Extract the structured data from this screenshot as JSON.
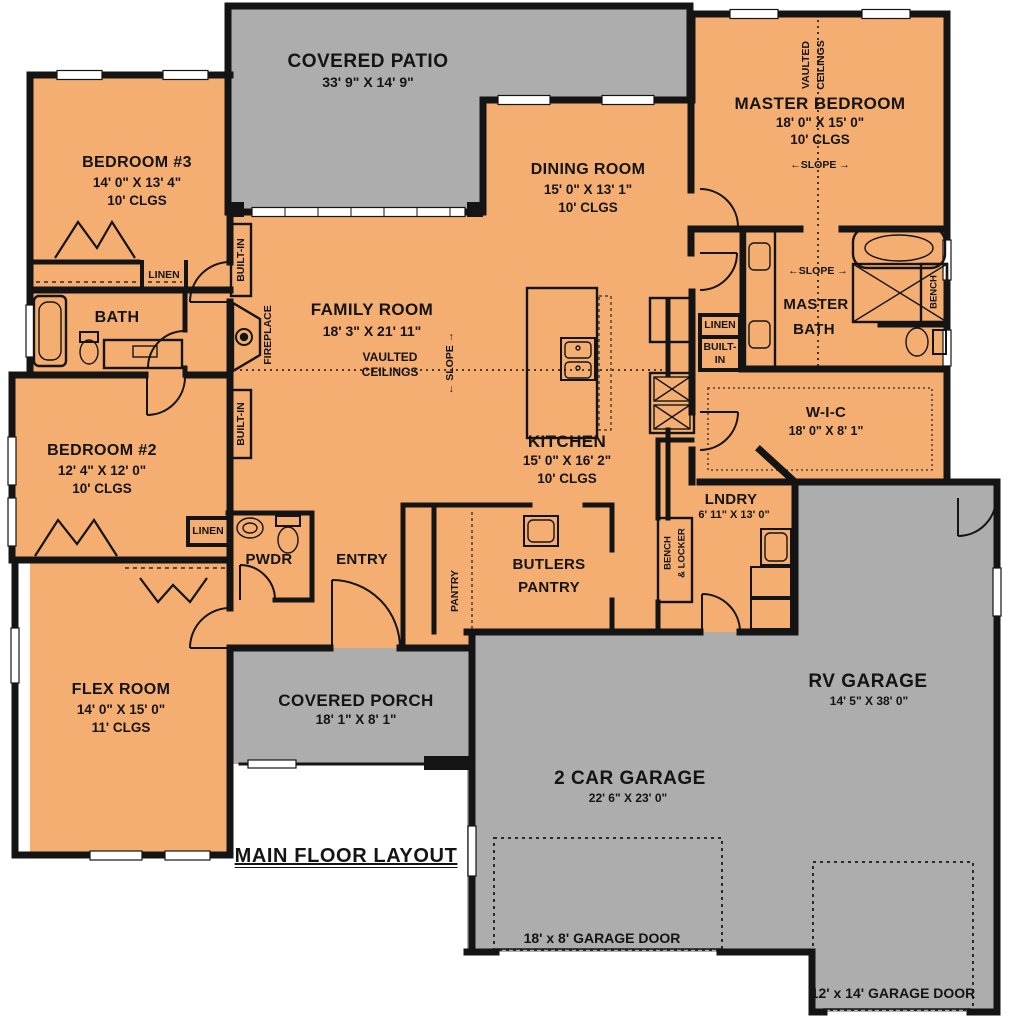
{
  "plan_title": "MAIN FLOOR LAYOUT",
  "colors": {
    "interior": "#F5AE72",
    "outdoor": "#ADADAD",
    "wall": "#141414",
    "background": "#FFFFFF"
  },
  "rooms": {
    "covered_patio": {
      "name": "COVERED PATIO",
      "dims": "33' 9\" X 14' 9\""
    },
    "master_bedroom": {
      "name": "MASTER BEDROOM",
      "dims": "18' 0\" X 15' 0\"",
      "ceiling": "10' CLGS"
    },
    "bedroom_3": {
      "name": "BEDROOM #3",
      "dims": "14' 0\" X 13' 4\"",
      "ceiling": "10' CLGS"
    },
    "dining_room": {
      "name": "DINING ROOM",
      "dims": "15' 0\" X 13' 1\"",
      "ceiling": "10' CLGS"
    },
    "family_room": {
      "name": "FAMILY ROOM",
      "dims": "18' 3\" X 21' 11\""
    },
    "bath": {
      "name": "BATH"
    },
    "bedroom_2": {
      "name": "BEDROOM #2",
      "dims": "12' 4\" X 12' 0\"",
      "ceiling": "10' CLGS"
    },
    "kitchen": {
      "name": "KITCHEN",
      "dims": "15' 0\" X 16' 2\"",
      "ceiling": "10' CLGS"
    },
    "master_bath": {
      "name_line1": "MASTER",
      "name_line2": "BATH"
    },
    "wic": {
      "name": "W-I-C",
      "dims": "18' 0\" X 8' 1\""
    },
    "laundry": {
      "name": "LNDRY",
      "dims": "6' 11\" X 13' 0\""
    },
    "butlers_pantry": {
      "name_line1": "BUTLERS",
      "name_line2": "PANTRY"
    },
    "pantry": {
      "name": "PANTRY"
    },
    "powder": {
      "name": "PWDR"
    },
    "entry": {
      "name": "ENTRY"
    },
    "flex_room": {
      "name": "FLEX ROOM",
      "dims": "14' 0\" X 15' 0\"",
      "ceiling": "11' CLGS"
    },
    "covered_porch": {
      "name": "COVERED PORCH",
      "dims": "18' 1\" X 8' 1\""
    },
    "two_car_garage": {
      "name": "2 CAR GARAGE",
      "dims": "22' 6\" X 23' 0\""
    },
    "rv_garage": {
      "name": "RV GARAGE",
      "dims": "14' 5\" X 38' 0\""
    }
  },
  "labels": {
    "linen": "LINEN",
    "built_in": "BUILT-IN",
    "built_in_line1": "BUILT-",
    "built_in_line2": "IN",
    "fireplace": "FIREPLACE",
    "vaulted": "VAULTED",
    "ceilings": "CEILINGS",
    "slope": "SLOPE",
    "bench": "BENCH",
    "bench_locker_line1": "BENCH",
    "bench_locker_line2": "& LOCKER"
  },
  "garage_doors": {
    "large": "18' x 8' GARAGE DOOR",
    "rv": "12' x 14' GARAGE DOOR"
  }
}
